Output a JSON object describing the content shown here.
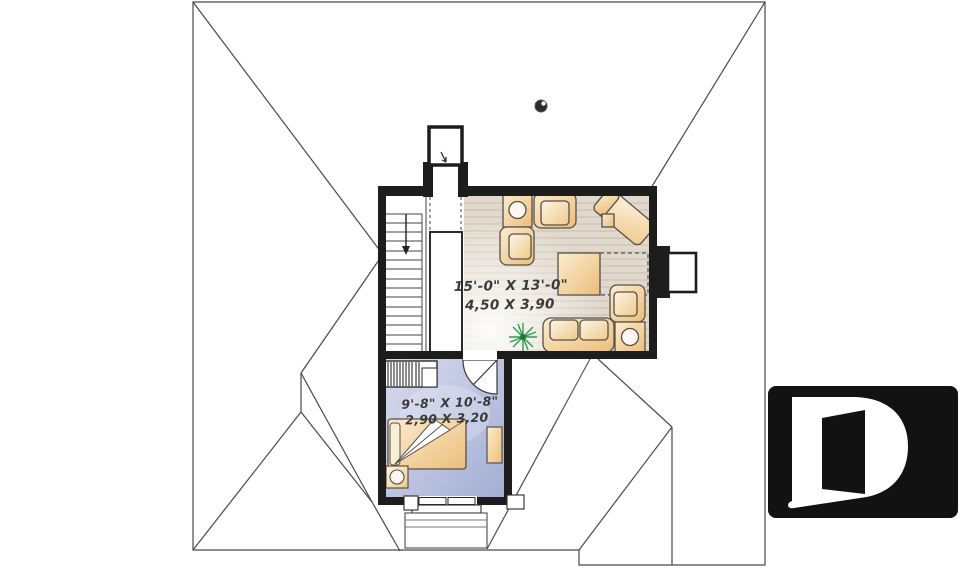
{
  "plan": {
    "type": "second floor plan",
    "living_room": {
      "dim_imperial": "15'-0\" X 13'-0\"",
      "dim_metric": "4,50 X 3,90"
    },
    "bedroom": {
      "dim_imperial": "9'-8\" X 10'-8\"",
      "dim_metric": "2,90 X 3,20"
    }
  },
  "logo": {
    "letter": "D",
    "background": "#121212",
    "foreground": "#ffffff"
  },
  "colors": {
    "wall": "#1d1d1d",
    "roof_line": "#4a4a4a",
    "wood_floor": "#e1d9cd",
    "wood_plank_line": "#c8bdae",
    "bedroom_floor_light": "#d8dbee",
    "bedroom_floor_dark": "#a3aed4",
    "furniture_light": "#f9e6c6",
    "furniture_dark": "#eec07c",
    "plant_green": "#2f9e4f",
    "dimension_text": "#3a3a3a"
  }
}
